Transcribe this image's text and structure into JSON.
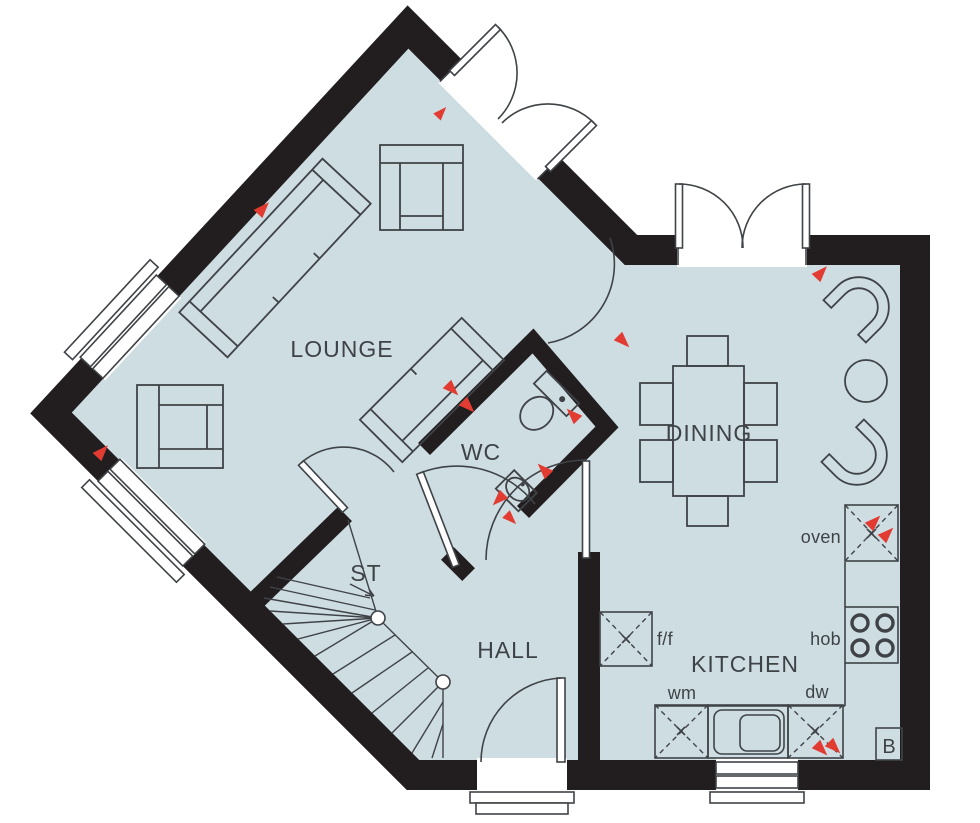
{
  "plan": {
    "rooms": {
      "lounge": "LOUNGE",
      "dining": "DINING",
      "wc": "WC",
      "store": "ST",
      "hall": "HALL",
      "kitchen": "KITCHEN"
    },
    "fixtures": {
      "oven": "oven",
      "hob": "hob",
      "washing_machine": "wm",
      "dishwasher": "dw",
      "fridge_freezer": "f/f",
      "boiler": "B"
    },
    "colors": {
      "floor": "#cedde2",
      "wall": "#221e1f",
      "line": "#3f4347",
      "marker": "#e23b32",
      "text": "#3e4347",
      "background": "#ffffff"
    }
  }
}
